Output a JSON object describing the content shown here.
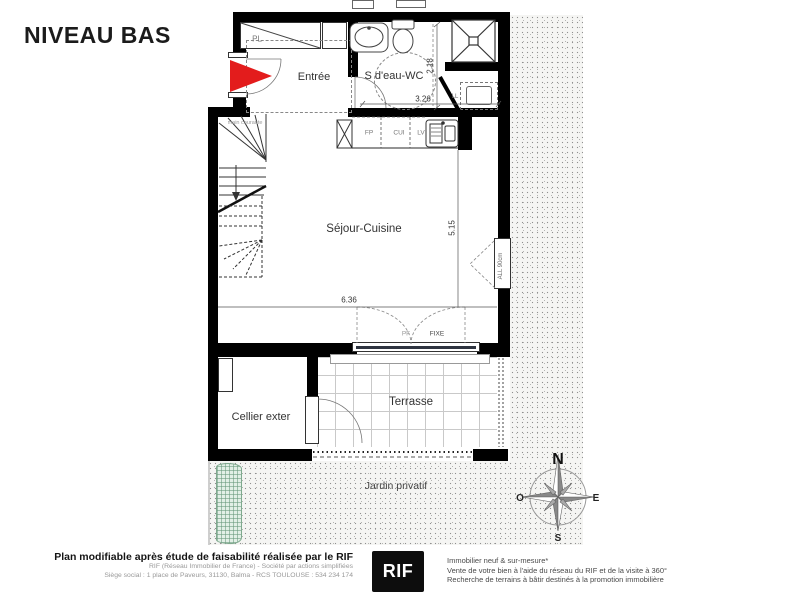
{
  "title": "NIVEAU BAS",
  "plan": {
    "rooms": {
      "entree": "Entrée",
      "bathroom": "S d'eau-WC",
      "living": "Séjour-Cuisine",
      "cellar": "Cellier exter",
      "terrace": "Terrasse",
      "garden": "Jardin privatif"
    },
    "labels": {
      "closet": "PL",
      "handrail": "main courante",
      "hotplate": "FP",
      "kitchen_unit": "CUI",
      "dishwasher": "LV",
      "washing_machine": "LL",
      "french_window": "PF",
      "fixed_pane": "FIXE",
      "sill_height": "ALL 90cm"
    },
    "dimensions": {
      "bathroom_depth": "2.18",
      "bathroom_width": "3.26",
      "living_depth": "5.15",
      "living_width": "6.36"
    },
    "compass": {
      "north": "N",
      "east": "E",
      "south": "S",
      "west": "O"
    }
  },
  "footer": {
    "disclaimer": "Plan modifiable après étude de faisabilité réalisée par le RIF",
    "company_line1": "RIF (Réseau Immobilier de France) - Société par actions simplifiées",
    "company_line2": "Siège social : 1 place de Paveurs, 31130, Balma - RCS TOULOUSE : 534 234 174",
    "logo": "RIF",
    "services": [
      "Immobilier neuf & sur-mesure*",
      "Vente de votre bien à l'aide du réseau du RIF et de la visite à 360°",
      "Recherche de terrains à bâtir destinés à la promotion immobilière"
    ]
  },
  "colors": {
    "wall": "#000000",
    "entrance_arrow": "#e31c1c",
    "hedge_green": "#e2efe6",
    "glass": "#2e3440"
  }
}
